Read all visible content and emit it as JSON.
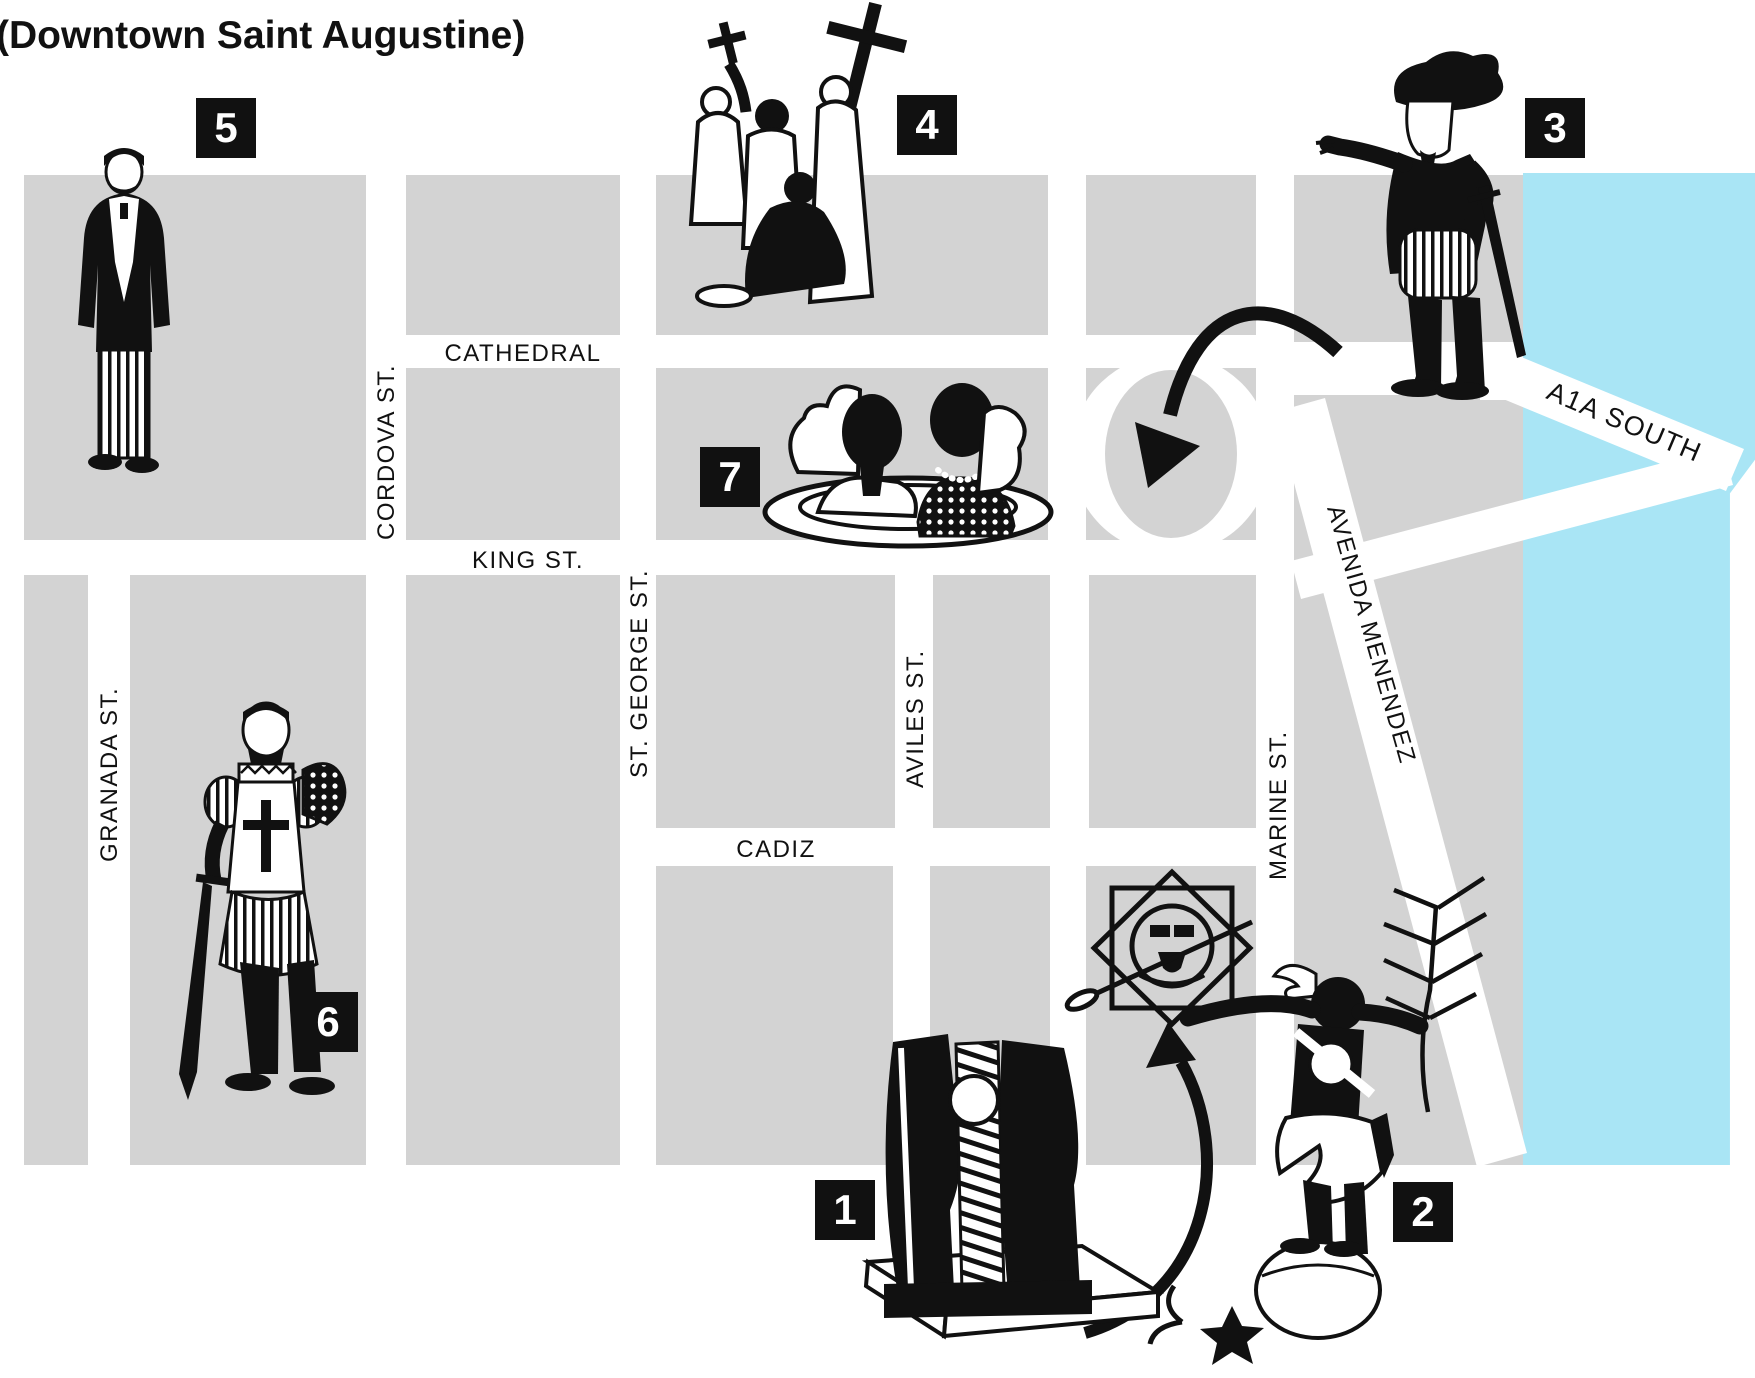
{
  "title": "(Downtown Saint Augustine)",
  "colors": {
    "block": "#d3d3d3",
    "water": "#a9e5f5",
    "ink": "#111111",
    "paper": "#ffffff"
  },
  "streets": {
    "cathedral": "CATHEDRAL",
    "king": "KING ST.",
    "cadiz": "CADIZ",
    "granada": "GRANADA ST.",
    "cordova": "CORDOVA ST.",
    "st_george": "ST. GEORGE ST.",
    "aviles": "AVILES ST.",
    "marine": "MARINE ST.",
    "avenida_menendez": "AVENIDA MENENDEZ",
    "a1a_south": "A1A SOUTH"
  },
  "markers": [
    {
      "number": "1",
      "icon": "abstract-monument-icon"
    },
    {
      "number": "2",
      "icon": "native-statue-icon"
    },
    {
      "number": "3",
      "icon": "conquistador-statue-icon"
    },
    {
      "number": "4",
      "icon": "religious-group-statue-icon"
    },
    {
      "number": "5",
      "icon": "gentleman-statue-icon"
    },
    {
      "number": "6",
      "icon": "knight-statue-icon"
    },
    {
      "number": "7",
      "icon": "busts-platter-icon"
    }
  ]
}
